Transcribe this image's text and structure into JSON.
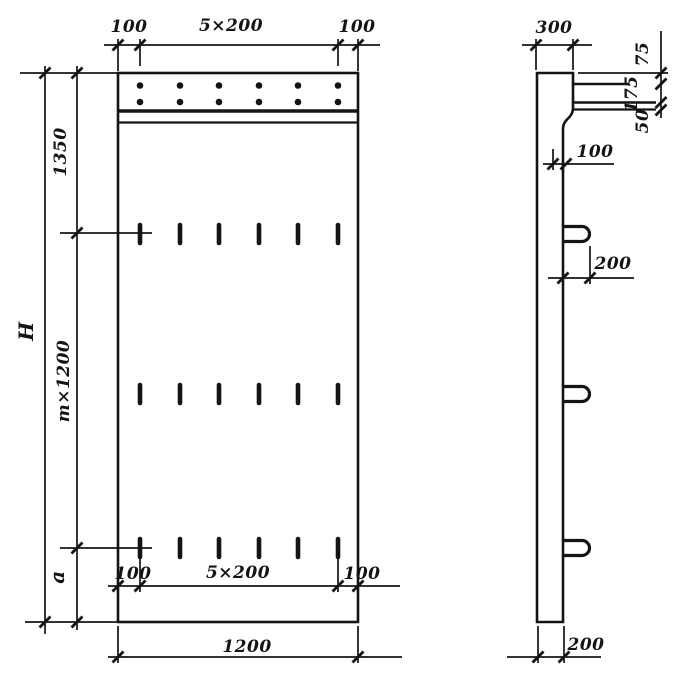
{
  "page": {
    "background_color": "#ffffff",
    "ink_color": "#141414",
    "description": "technical drawing of precast panel, front and side views"
  },
  "front_view": {
    "top_dims": {
      "left": "100",
      "middle": "5×200",
      "right": "100"
    },
    "left_dims": {
      "total": "H",
      "upper": "1350",
      "middle": "m×1200",
      "lower": "a"
    },
    "bottom_dims": {
      "inner_left": "100",
      "inner_middle": "5×200",
      "inner_right": "100",
      "overall": "1200"
    }
  },
  "side_view": {
    "top_dim": "300",
    "right_dims": {
      "upper": "75",
      "middle": "175",
      "lower": "50"
    },
    "step_dim": "100",
    "loop_dim": "200",
    "bottom_dim": "200"
  }
}
